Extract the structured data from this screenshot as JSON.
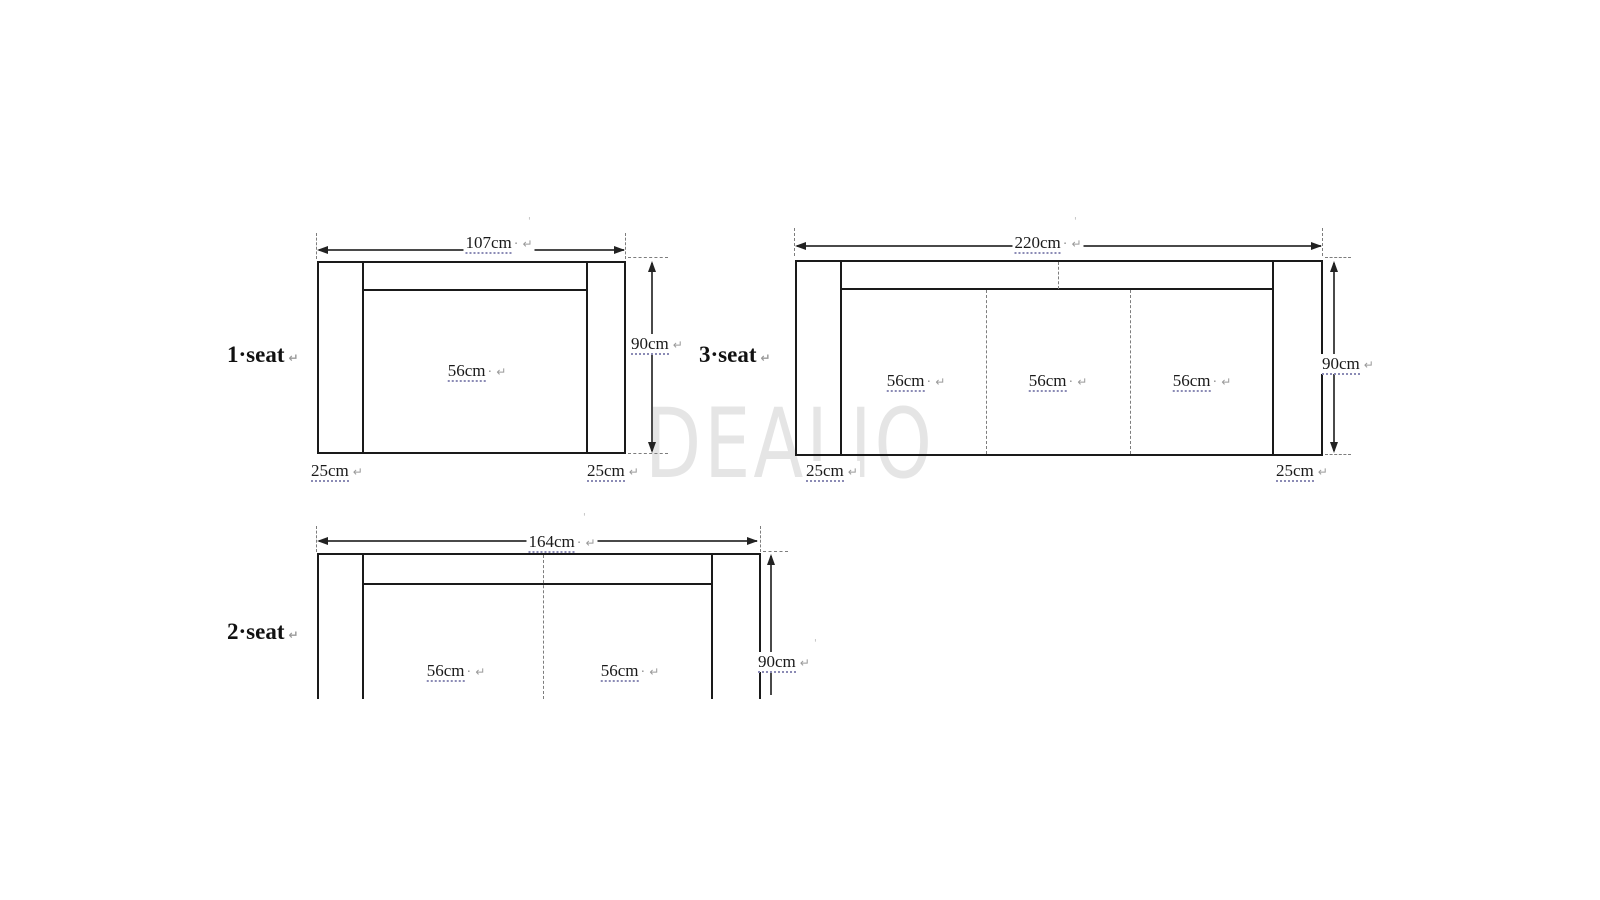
{
  "watermark": "DEALIO",
  "marks": {
    "pilcrow": "↵",
    "dot": "·",
    "tick": "'"
  },
  "diagrams": [
    {
      "id": "one-seat",
      "title": "1·seat",
      "width_label": "107cm",
      "height_label": "90cm",
      "seat_labels": [
        "56cm"
      ],
      "armrest_labels": [
        "25cm",
        "25cm"
      ]
    },
    {
      "id": "three-seat",
      "title": "3·seat",
      "width_label": "220cm",
      "height_label": "90cm",
      "seat_labels": [
        "56cm",
        "56cm",
        "56cm"
      ],
      "armrest_labels": [
        "25cm",
        "25cm"
      ]
    },
    {
      "id": "two-seat",
      "title": "2·seat",
      "width_label": "164cm",
      "height_label": "90cm",
      "seat_labels": [
        "56cm",
        "56cm"
      ],
      "armrest_labels": []
    }
  ]
}
